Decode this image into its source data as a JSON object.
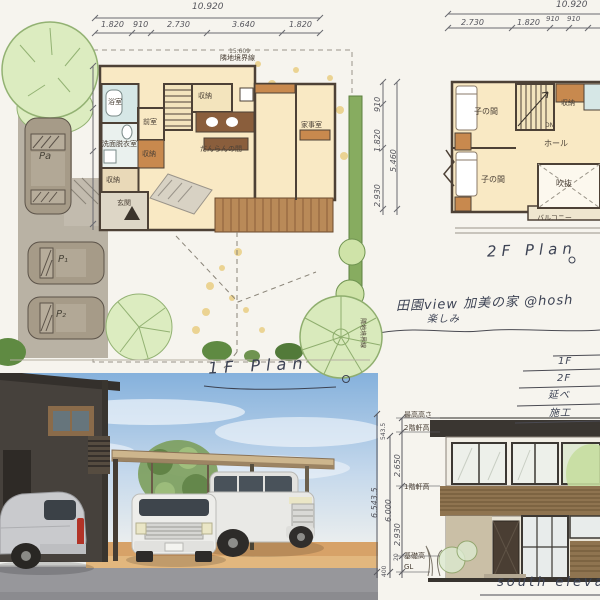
{
  "site_plan": {
    "total_dim": "10.920",
    "top_dims": [
      "1.820",
      "910",
      "2.730",
      "3.640",
      "1.820"
    ],
    "boundary_top_value": "15.609",
    "boundary_top_label": "隣地境界線",
    "boundary_right_label": "隣地境界線",
    "right_dims": [
      "910",
      "1.820",
      "2.930"
    ],
    "right_total_dim": "5.460",
    "rooms": {
      "bath": "浴室",
      "washroom": "洗面脱衣室",
      "anteroom": "前室",
      "storage_a": "収納",
      "storage_b": "収納",
      "storage_c": "収納",
      "family_room": "だんらんの間",
      "utility_room": "家事室",
      "entrance": "玄関"
    },
    "parking": [
      "Pa",
      "P₁",
      "P₂"
    ],
    "caption": "1F Plan"
  },
  "floor2": {
    "total_dim": "10.920",
    "top_dims": [
      "2.730",
      "1.820",
      "910",
      "910"
    ],
    "rooms": {
      "kids_a": "子の間",
      "kids_b": "子の間",
      "hall": "ホール",
      "void": "吹抜",
      "balcony": "バルコニー",
      "storage": "収納",
      "stairs_dn": "DN"
    },
    "caption": "2F Plan"
  },
  "notes": {
    "title": "田園view 加美の家 @hosh",
    "subtitle": "楽しみ",
    "area_rows": [
      "1F",
      "2F",
      "延べ",
      "施工"
    ]
  },
  "elevation": {
    "labels": {
      "max_height": "最高高さ",
      "eave_2f": "2階軒高",
      "eave_1f": "1階軒高",
      "foundation": "基礎高",
      "ground": "GL"
    },
    "dims": {
      "roof": "543.5",
      "upper": "2.650",
      "lower": "2.930",
      "subtotal": "6.000",
      "total": "6.543.5",
      "base": "400",
      "plinth": "20"
    },
    "caption": "south elevation"
  },
  "colors": {
    "paper": "#f6f4ee",
    "plan_floor": "#f9e9c4",
    "wall_accent": "#c8894e",
    "bath_blue": "#d6e7e6",
    "deck_wood": "#b98a58",
    "tree_green": "#dcecc0",
    "hedge_green": "#87ac60",
    "driveway_gray": "#b9b2a4",
    "sky_blue": "#85b1dc",
    "road_gray": "#97979b",
    "ground_tan": "#d7a268",
    "house_dark": "#46413c",
    "carport_beige": "#cdb68d",
    "ink": "#3d4354"
  }
}
